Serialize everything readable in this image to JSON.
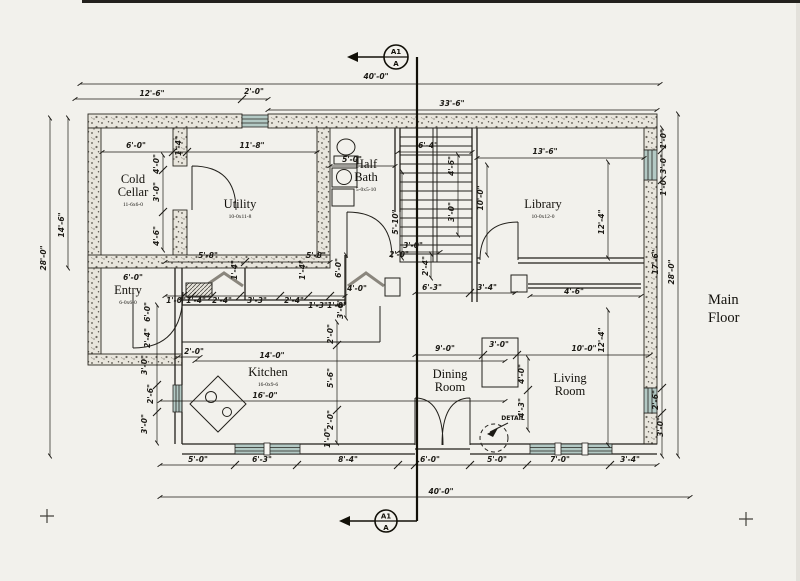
{
  "title": {
    "line1": "Main",
    "line2": "Floor"
  },
  "annotations": {
    "detail": "DETAIL"
  },
  "section_markers": {
    "top": {
      "primary": "A1",
      "secondary": "A"
    },
    "bottom": {
      "primary": "A1",
      "secondary": "A"
    }
  },
  "colors": {
    "ink": "#1d1b16",
    "paper": "#f2f1ec",
    "wall_fill": "#e8e5dc",
    "glazing": "#b3c9c4"
  },
  "rooms": [
    {
      "lines": [
        "Cold",
        "Cellar"
      ],
      "size": "11-6x6-0",
      "x": 133,
      "y": 183
    },
    {
      "lines": [
        "Utility"
      ],
      "size": "10-0x11-8",
      "x": 240,
      "y": 208
    },
    {
      "lines": [
        "Half",
        "Bath"
      ],
      "size": "5-0x5-10",
      "x": 366,
      "y": 168
    },
    {
      "lines": [
        "Library"
      ],
      "size": "10-0x12-0",
      "x": 543,
      "y": 208
    },
    {
      "lines": [
        "Entry"
      ],
      "size": "6-0x6-0",
      "x": 128,
      "y": 294
    },
    {
      "lines": [
        "Kitchen"
      ],
      "size": "16-0x9-6",
      "x": 268,
      "y": 376
    },
    {
      "lines": [
        "Dining",
        "Room"
      ],
      "x": 450,
      "y": 378
    },
    {
      "lines": [
        "Living",
        "Room"
      ],
      "x": 570,
      "y": 382
    }
  ],
  "dimensions": [
    {
      "t": "40'-0\"",
      "x": 376,
      "y": 79,
      "r": 0
    },
    {
      "t": "12'-6\"",
      "x": 152,
      "y": 96,
      "r": 0
    },
    {
      "t": "2'-0\"",
      "x": 254,
      "y": 94,
      "r": 0
    },
    {
      "t": "33'-6\"",
      "x": 452,
      "y": 106,
      "r": 0
    },
    {
      "t": "6'-0\"",
      "x": 136,
      "y": 148,
      "r": 0
    },
    {
      "t": "11'-8\"",
      "x": 252,
      "y": 148,
      "r": 0
    },
    {
      "t": "1'-4\"",
      "x": 181,
      "y": 146,
      "r": -90
    },
    {
      "t": "5'-0\"",
      "x": 352,
      "y": 162,
      "r": 0
    },
    {
      "t": "6'-4\"",
      "x": 428,
      "y": 148,
      "r": 0
    },
    {
      "t": "13'-6\"",
      "x": 545,
      "y": 154,
      "r": 0
    },
    {
      "t": "14'-6\"",
      "x": 64,
      "y": 225,
      "r": -90
    },
    {
      "t": "28'-0\"",
      "x": 46,
      "y": 258,
      "r": -90
    },
    {
      "t": "4'-0\"",
      "x": 159,
      "y": 164,
      "r": -90
    },
    {
      "t": "3'-0\"",
      "x": 159,
      "y": 192,
      "r": -90
    },
    {
      "t": "4'-6\"",
      "x": 159,
      "y": 236,
      "r": -90
    },
    {
      "t": "4'-6\"",
      "x": 454,
      "y": 166,
      "r": -90
    },
    {
      "t": "5'-10\"",
      "x": 398,
      "y": 222,
      "r": -90
    },
    {
      "t": "3'-0\"",
      "x": 454,
      "y": 212,
      "r": -90
    },
    {
      "t": "3'-0\"",
      "x": 413,
      "y": 248,
      "r": 0
    },
    {
      "t": "2'-0\"",
      "x": 399,
      "y": 257,
      "r": 0
    },
    {
      "t": "2'-4\"",
      "x": 428,
      "y": 266,
      "r": -90
    },
    {
      "t": "10'-0\"",
      "x": 483,
      "y": 198,
      "r": -90
    },
    {
      "t": "12'-4\"",
      "x": 604,
      "y": 222,
      "r": -90
    },
    {
      "t": "1'-0\"",
      "x": 666,
      "y": 139,
      "r": -90
    },
    {
      "t": "3'-0\"",
      "x": 666,
      "y": 164,
      "r": -90
    },
    {
      "t": "1'-0\"",
      "x": 666,
      "y": 186,
      "r": -90
    },
    {
      "t": "17'-6\"",
      "x": 658,
      "y": 262,
      "r": -90
    },
    {
      "t": "28'-0\"",
      "x": 674,
      "y": 272,
      "r": -90
    },
    {
      "t": "5'-8\"",
      "x": 208,
      "y": 258,
      "r": 0
    },
    {
      "t": "5'-8\"",
      "x": 316,
      "y": 258,
      "r": 0
    },
    {
      "t": "1'-4\"",
      "x": 237,
      "y": 270,
      "r": -90
    },
    {
      "t": "1'-4\"",
      "x": 305,
      "y": 270,
      "r": -90
    },
    {
      "t": "1'-0\"",
      "x": 176,
      "y": 303,
      "r": 0
    },
    {
      "t": "1'-4\"",
      "x": 196,
      "y": 303,
      "r": 0
    },
    {
      "t": "2'-4\"",
      "x": 222,
      "y": 303,
      "r": 0
    },
    {
      "t": "3'-3\"",
      "x": 257,
      "y": 303,
      "r": 0
    },
    {
      "t": "2'-4\"",
      "x": 294,
      "y": 303,
      "r": 0
    },
    {
      "t": "1'-3\"",
      "x": 318,
      "y": 308,
      "r": 0
    },
    {
      "t": "1'-0\"",
      "x": 337,
      "y": 308,
      "r": 0
    },
    {
      "t": "6'-0\"",
      "x": 341,
      "y": 268,
      "r": -90
    },
    {
      "t": "4'-0\"",
      "x": 357,
      "y": 291,
      "r": 0
    },
    {
      "t": "3'-6\"",
      "x": 343,
      "y": 309,
      "r": -90
    },
    {
      "t": "6'-3\"",
      "x": 432,
      "y": 290,
      "r": 0
    },
    {
      "t": "3'-4\"",
      "x": 487,
      "y": 290,
      "r": 0
    },
    {
      "t": "4'-6\"",
      "x": 574,
      "y": 294,
      "r": 0
    },
    {
      "t": "6'-0\"",
      "x": 133,
      "y": 280,
      "r": 0
    },
    {
      "t": "6'-0\"",
      "x": 150,
      "y": 312,
      "r": -90
    },
    {
      "t": "2'-4\"",
      "x": 150,
      "y": 338,
      "r": -90
    },
    {
      "t": "3'-0\"",
      "x": 147,
      "y": 365,
      "r": -90
    },
    {
      "t": "2'-6\"",
      "x": 153,
      "y": 394,
      "r": -90
    },
    {
      "t": "3'-0\"",
      "x": 147,
      "y": 424,
      "r": -90
    },
    {
      "t": "2'-0\"",
      "x": 194,
      "y": 354,
      "r": 0
    },
    {
      "t": "14'-0\"",
      "x": 272,
      "y": 358,
      "r": 0
    },
    {
      "t": "16'-0\"",
      "x": 265,
      "y": 398,
      "r": 0
    },
    {
      "t": "2'-0\"",
      "x": 333,
      "y": 334,
      "r": -90
    },
    {
      "t": "5'-6\"",
      "x": 333,
      "y": 378,
      "r": -90
    },
    {
      "t": "2'-0\"",
      "x": 333,
      "y": 420,
      "r": -90
    },
    {
      "t": "1'-0\"",
      "x": 330,
      "y": 438,
      "r": -90
    },
    {
      "t": "9'-0\"",
      "x": 445,
      "y": 351,
      "r": 0
    },
    {
      "t": "3'-0\"",
      "x": 499,
      "y": 347,
      "r": 0
    },
    {
      "t": "10'-0\"",
      "x": 584,
      "y": 351,
      "r": 0
    },
    {
      "t": "12'-4\"",
      "x": 604,
      "y": 340,
      "r": -90
    },
    {
      "t": "4'-0\"",
      "x": 524,
      "y": 374,
      "r": -90
    },
    {
      "t": "4'-3\"",
      "x": 524,
      "y": 408,
      "r": -90
    },
    {
      "t": "2'-6\"",
      "x": 658,
      "y": 400,
      "r": -90
    },
    {
      "t": "3'-0\"",
      "x": 663,
      "y": 427,
      "r": -90
    },
    {
      "t": "5'-0\"",
      "x": 198,
      "y": 462,
      "r": 0
    },
    {
      "t": "6'-3\"",
      "x": 262,
      "y": 462,
      "r": 0
    },
    {
      "t": "8'-4\"",
      "x": 348,
      "y": 462,
      "r": 0
    },
    {
      "t": "6'-0\"",
      "x": 430,
      "y": 462,
      "r": 0
    },
    {
      "t": "5'-0\"",
      "x": 497,
      "y": 462,
      "r": 0
    },
    {
      "t": "7'-0\"",
      "x": 560,
      "y": 462,
      "r": 0
    },
    {
      "t": "3'-4\"",
      "x": 630,
      "y": 462,
      "r": 0
    },
    {
      "t": "40'-0\"",
      "x": 441,
      "y": 494,
      "r": 0
    }
  ]
}
